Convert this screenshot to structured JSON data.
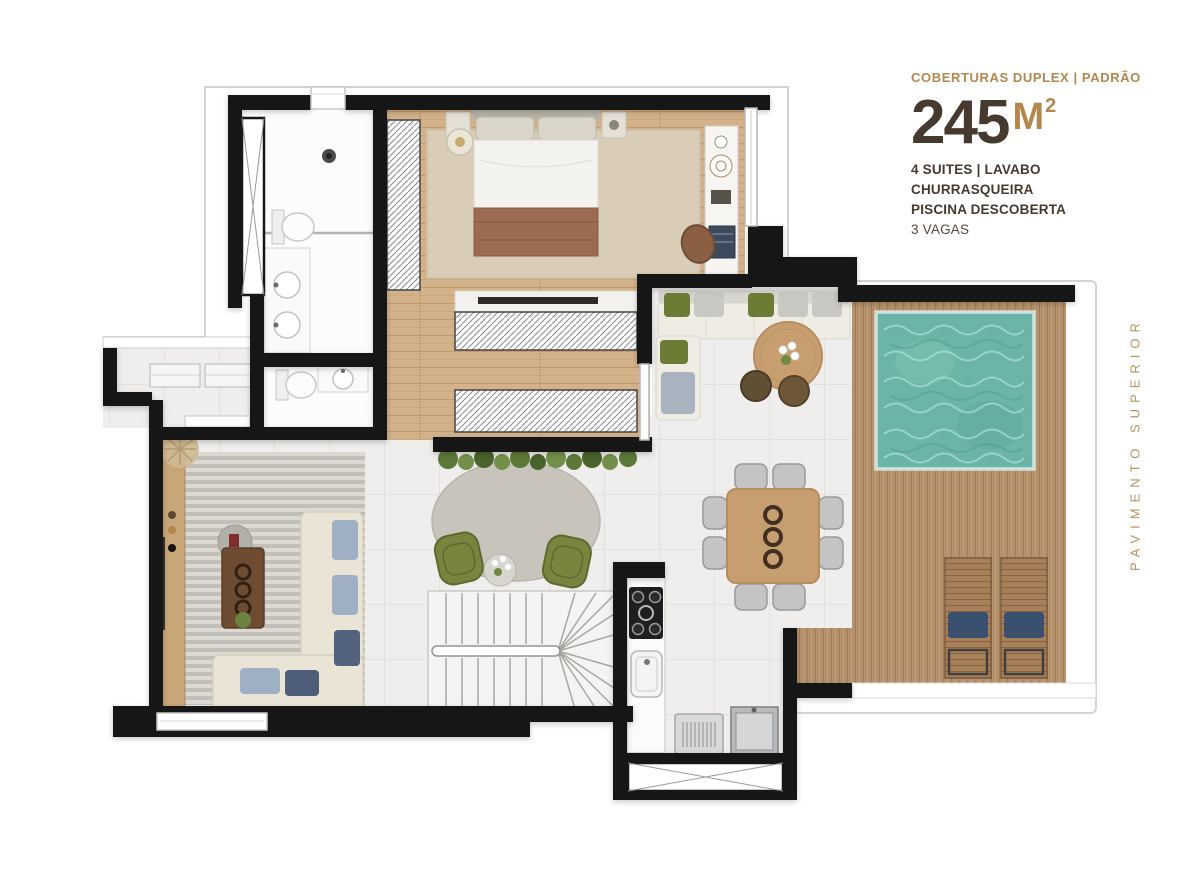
{
  "header": {
    "category": "COBERTURAS DUPLEX | PADRÃO",
    "area": {
      "value": "245",
      "unit": "M",
      "sup": "2"
    },
    "features": [
      "4 SUITES | LAVABO",
      "CHURRASQUEIRA",
      "PISCINA DESCOBERTA",
      "3 VAGAS"
    ]
  },
  "side_label": "PAVIMENTO SUPERIOR",
  "colors": {
    "accent_gold": "#b4874f",
    "text_brown": "#46392e",
    "wall_black": "#171717",
    "pool_teal": "#6ab5a7",
    "deck_wood": "#b5916c",
    "floor_wood": "#d3b289",
    "tile_floor": "#efeeec"
  }
}
